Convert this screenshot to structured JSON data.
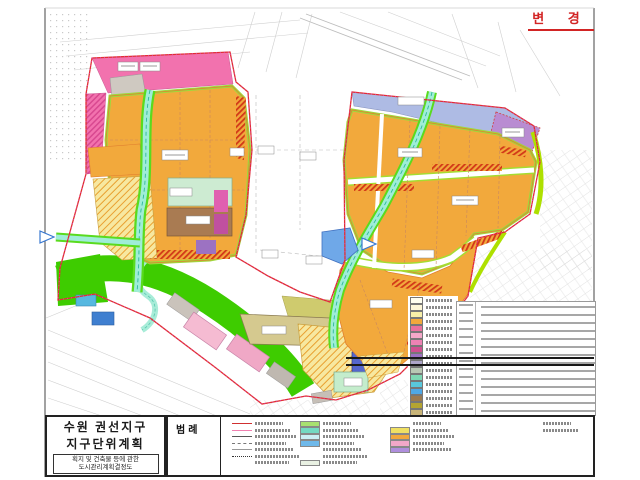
{
  "sheet": {
    "change_label": "변 경"
  },
  "title_block": {
    "line1": "수원 권선지구",
    "line2": "지구단위계획",
    "sub_line1": "획지 및 건축물 등에 관한",
    "sub_line2": "도시관리계획결정도"
  },
  "legend": {
    "title": "범례"
  },
  "map_legend": {
    "swatches": [
      "#FFFFF0",
      "#FDF7D8",
      "#F7EFA8",
      "#F2A83C",
      "#E9709E",
      "#F4A8C8",
      "#EE82B4",
      "#D05090",
      "#9C72C2",
      "#ADA5C8",
      "#B9C8B4",
      "#7ED8B4",
      "#59C8DC",
      "#4FA8E6",
      "#9C7A50",
      "#B4A432",
      "#C8B478",
      "#4868D2"
    ]
  },
  "bottom_legend": {
    "g1": [
      {
        "t": "line",
        "c": "#D03030"
      },
      {
        "t": "line",
        "c": "#F080B0"
      },
      {
        "t": "line",
        "c": "#555555"
      },
      {
        "t": "dash",
        "c": "#777777"
      },
      {
        "t": "line",
        "c": "#999999"
      },
      {
        "t": "dashdot",
        "c": "#333333"
      },
      {
        "t": "text",
        "c": ""
      }
    ],
    "g2": [
      {
        "t": "patch",
        "c": "#A8E070"
      },
      {
        "t": "patch",
        "c": "#74D9C2"
      },
      {
        "t": "patch",
        "c": "#CBEFF5"
      },
      {
        "t": "patch",
        "c": "#6FB9EA"
      },
      {
        "t": "text",
        "c": ""
      },
      {
        "t": "text",
        "c": ""
      },
      {
        "t": "patch",
        "c": "#E9F1E3"
      }
    ],
    "g3": [
      {
        "t": "text",
        "c": ""
      },
      {
        "t": "patch",
        "c": "#F0E062"
      },
      {
        "t": "patch",
        "c": "#F2A83C"
      },
      {
        "t": "patch",
        "c": "#F2A8C8"
      },
      {
        "t": "patch",
        "c": "#AF8EDC"
      }
    ],
    "g4": [
      {
        "t": "text",
        "c": ""
      },
      {
        "t": "text",
        "c": ""
      }
    ]
  },
  "colors": {
    "zone_orange": "#F2A93C",
    "zone_pink": "#F272AE",
    "park_green": "#3ECC00",
    "river_water": "#9FEDD8",
    "river_bank_green": "#5ADB1E",
    "lavender_strip": "#AEBBE4",
    "purple_parcel": "#B98CD2",
    "housing_yellow": "#F7E8A0",
    "hatch_red": "#D23818",
    "boundary_red": "#E03030",
    "boundary_dot_magenta": "#E040C0",
    "stamp_red": "#D22424"
  }
}
